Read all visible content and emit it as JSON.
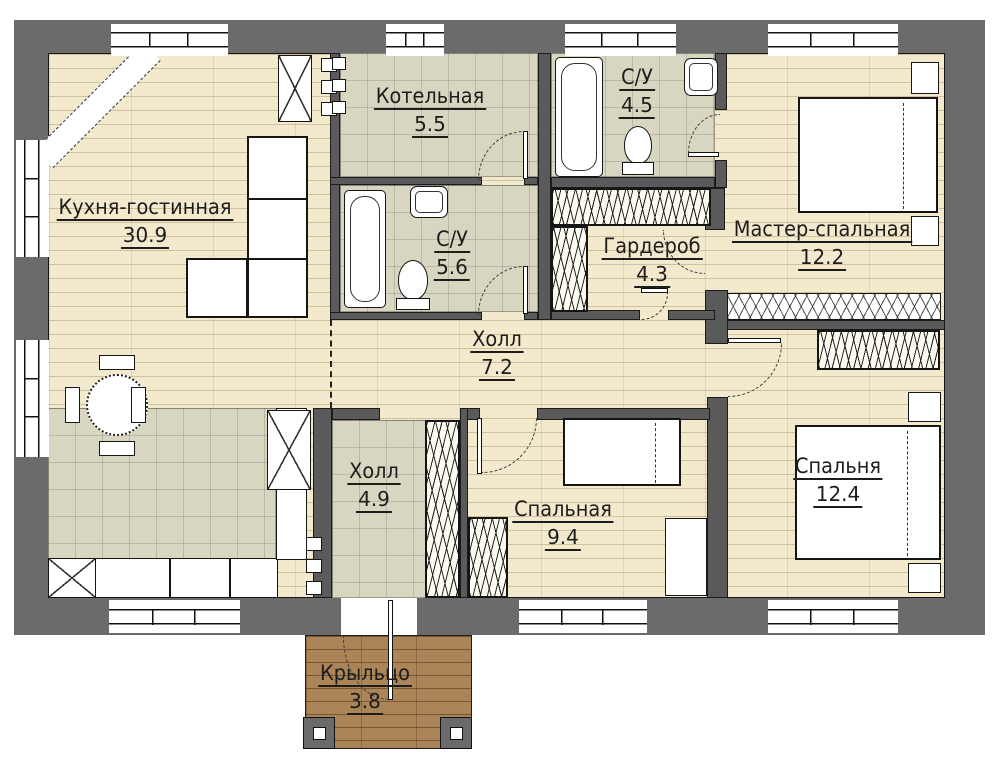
{
  "plan": {
    "type": "floor-plan",
    "language": "ru"
  },
  "colors": {
    "paper": "#ffffff",
    "wall": "#6b6b6b",
    "partition": "#5a5a5a",
    "wood": "#f3e9cd",
    "tile": "#d8d6c1",
    "deck": "#ab8458",
    "line": "#1a1a1a"
  },
  "rooms": [
    {
      "name": "Кухня-гостинная",
      "area": "30.9"
    },
    {
      "name": "Котельная",
      "area": "5.5"
    },
    {
      "name": "С/У",
      "area": "5.6"
    },
    {
      "name": "С/У",
      "area": "4.5"
    },
    {
      "name": "Гардероб",
      "area": "4.3"
    },
    {
      "name": "Мастер-спальная",
      "area": "12.2"
    },
    {
      "name": "Холл",
      "area": "7.2"
    },
    {
      "name": "Холл",
      "area": "4.9"
    },
    {
      "name": "Спальная",
      "area": "9.4"
    },
    {
      "name": "Спальня",
      "area": "12.4"
    },
    {
      "name": "Крыльцо",
      "area": "3.8"
    }
  ]
}
